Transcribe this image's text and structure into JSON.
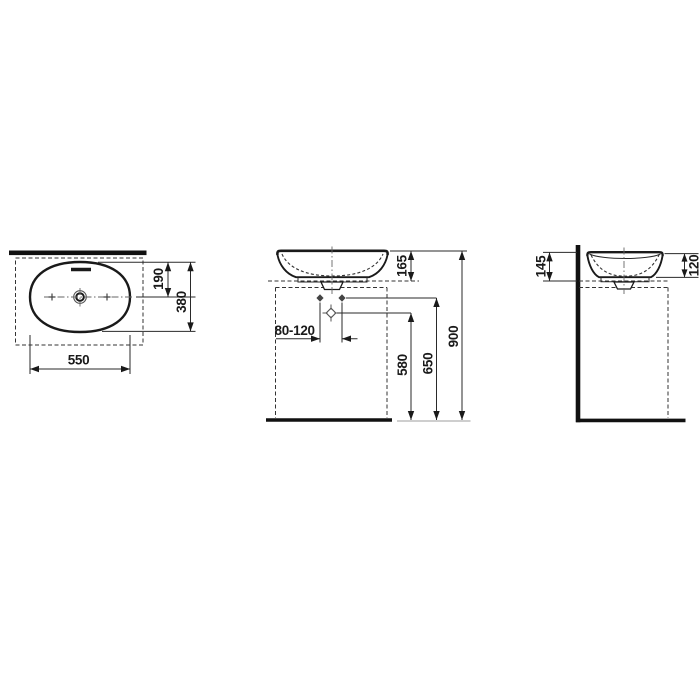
{
  "drawing": {
    "top_view": {
      "width": "550",
      "depth": "380",
      "center_offset": "190"
    },
    "front_view": {
      "basin_height": "165",
      "tap_distance": "80-120",
      "drain_height": "580",
      "supply_height": "650",
      "overall_height": "900"
    },
    "side_view": {
      "back_height": "145",
      "front_height": "120"
    }
  },
  "colors": {
    "line": "#1a1a1a",
    "dim_line": "#2a2a2a",
    "centerline": "#666666",
    "floor_extension": "#b0b0b0",
    "background": "#ffffff"
  }
}
